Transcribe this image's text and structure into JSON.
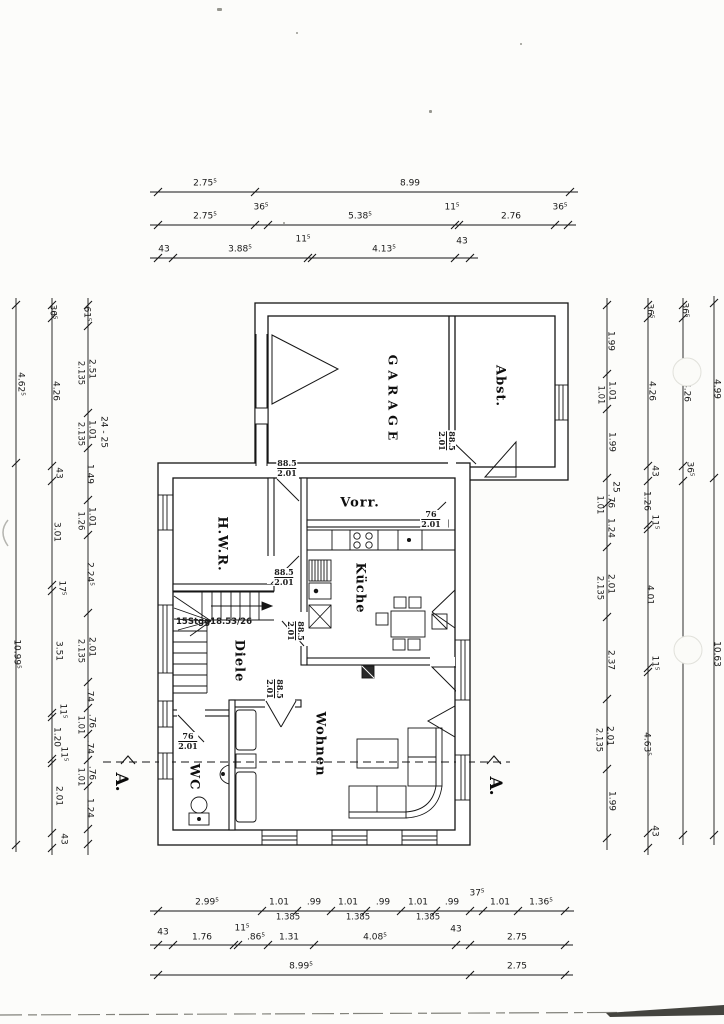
{
  "drawing_title": "Erdgeschoss Grundriss (scanned floor plan)",
  "rooms": [
    {
      "label": "GARAGE",
      "x": 393,
      "y": 400,
      "r": 90,
      "spaced": true
    },
    {
      "label": "Abst.",
      "x": 500,
      "y": 386,
      "r": 90,
      "spaced": false
    },
    {
      "label": "Vorr.",
      "x": 360,
      "y": 503,
      "r": 0,
      "spaced": false
    },
    {
      "label": "H.W.R.",
      "x": 222,
      "y": 544,
      "r": 90,
      "spaced": false
    },
    {
      "label": "Küche",
      "x": 360,
      "y": 588,
      "r": 90,
      "spaced": false
    },
    {
      "label": "Diele",
      "x": 239,
      "y": 661,
      "r": 90,
      "spaced": false
    },
    {
      "label": "WC",
      "x": 194,
      "y": 777,
      "r": 90,
      "spaced": false
    },
    {
      "label": "Wohnen",
      "x": 320,
      "y": 744,
      "r": 90,
      "spaced": false
    }
  ],
  "section_markers": [
    {
      "label": "A.",
      "x": 121,
      "y": 782
    },
    {
      "label": "A.",
      "x": 495,
      "y": 786
    }
  ],
  "stair_note": {
    "text": "15Stgg18.53/26",
    "x": 214,
    "y": 622
  },
  "door_labels": [
    {
      "w": "88.5",
      "h": "2.01",
      "x": 287,
      "y": 468,
      "r": 0
    },
    {
      "w": "88.5",
      "h": "2.01",
      "x": 447,
      "y": 441,
      "r": 90
    },
    {
      "w": "76",
      "h": "2.01",
      "x": 431,
      "y": 519,
      "r": 0
    },
    {
      "w": "88.5",
      "h": "2.01",
      "x": 284,
      "y": 577,
      "r": 0
    },
    {
      "w": "88.5",
      "h": "2.01",
      "x": 296,
      "y": 631,
      "r": 90
    },
    {
      "w": "88.5",
      "h": "2.01",
      "x": 275,
      "y": 689,
      "r": 90
    },
    {
      "w": "76",
      "h": "2.01",
      "x": 188,
      "y": 741,
      "r": 0
    }
  ],
  "dim_labels": [
    {
      "t": "2.75⁵",
      "x": 205,
      "y": 184,
      "r": 0
    },
    {
      "t": "8.99",
      "x": 410,
      "y": 184,
      "r": 0
    },
    {
      "t": "2.75⁵",
      "x": 205,
      "y": 217,
      "r": 0
    },
    {
      "t": "36⁵",
      "x": 261,
      "y": 208,
      "r": 0
    },
    {
      "t": "5.38⁵",
      "x": 360,
      "y": 217,
      "r": 0
    },
    {
      "t": "11⁵",
      "x": 452,
      "y": 208,
      "r": 0
    },
    {
      "t": "2.76",
      "x": 511,
      "y": 217,
      "r": 0
    },
    {
      "t": "36⁵",
      "x": 560,
      "y": 208,
      "r": 0
    },
    {
      "t": "43",
      "x": 164,
      "y": 250,
      "r": 0
    },
    {
      "t": "3.88⁵",
      "x": 240,
      "y": 250,
      "r": 0
    },
    {
      "t": "11⁵",
      "x": 303,
      "y": 240,
      "r": 0
    },
    {
      "t": "4.13⁵",
      "x": 384,
      "y": 250,
      "r": 0
    },
    {
      "t": "43",
      "x": 462,
      "y": 242,
      "r": 0
    },
    {
      "t": "2.99⁵",
      "x": 207,
      "y": 903,
      "r": 0
    },
    {
      "t": "1.01",
      "x": 279,
      "y": 903,
      "r": 0
    },
    {
      "t": ".99",
      "x": 314,
      "y": 903,
      "r": 0
    },
    {
      "t": "1.01",
      "x": 348,
      "y": 903,
      "r": 0
    },
    {
      "t": ".99",
      "x": 383,
      "y": 903,
      "r": 0
    },
    {
      "t": "1.01",
      "x": 418,
      "y": 903,
      "r": 0
    },
    {
      "t": ".99",
      "x": 452,
      "y": 903,
      "r": 0
    },
    {
      "t": "37⁵",
      "x": 477,
      "y": 894,
      "r": 0
    },
    {
      "t": "1.01",
      "x": 500,
      "y": 903,
      "r": 0
    },
    {
      "t": "1.36⁵",
      "x": 541,
      "y": 903,
      "r": 0
    },
    {
      "t": "1.385",
      "x": 288,
      "y": 918,
      "r": 0,
      "sub": true
    },
    {
      "t": "1.385",
      "x": 358,
      "y": 918,
      "r": 0,
      "sub": true
    },
    {
      "t": "1.385",
      "x": 428,
      "y": 918,
      "r": 0,
      "sub": true
    },
    {
      "t": "43",
      "x": 163,
      "y": 933,
      "r": 0
    },
    {
      "t": "1.76",
      "x": 202,
      "y": 938,
      "r": 0
    },
    {
      "t": "11⁵",
      "x": 242,
      "y": 929,
      "r": 0
    },
    {
      "t": ".86⁵",
      "x": 256,
      "y": 938,
      "r": 0
    },
    {
      "t": "1.31",
      "x": 289,
      "y": 938,
      "r": 0
    },
    {
      "t": "4.08⁵",
      "x": 375,
      "y": 938,
      "r": 0
    },
    {
      "t": "43",
      "x": 456,
      "y": 930,
      "r": 0
    },
    {
      "t": "2.75",
      "x": 517,
      "y": 938,
      "r": 0
    },
    {
      "t": "8.99⁵",
      "x": 301,
      "y": 967,
      "r": 0
    },
    {
      "t": "2.75",
      "x": 517,
      "y": 967,
      "r": 0
    },
    {
      "t": "4.62⁵",
      "x": 20,
      "y": 384,
      "r": 90
    },
    {
      "t": "10.99⁵",
      "x": 16,
      "y": 654,
      "r": 90
    },
    {
      "t": "36⁵",
      "x": 52,
      "y": 312,
      "r": 90
    },
    {
      "t": "4.26",
      "x": 55,
      "y": 391,
      "r": 90
    },
    {
      "t": "43",
      "x": 58,
      "y": 473,
      "r": 90
    },
    {
      "t": "3.01",
      "x": 56,
      "y": 532,
      "r": 90
    },
    {
      "t": "17⁵",
      "x": 61,
      "y": 588,
      "r": 90
    },
    {
      "t": "3.51",
      "x": 58,
      "y": 651,
      "r": 90
    },
    {
      "t": "11⁵",
      "x": 62,
      "y": 711,
      "r": 90
    },
    {
      "t": "1.20",
      "x": 56,
      "y": 737,
      "r": 90
    },
    {
      "t": "11⁵",
      "x": 63,
      "y": 754,
      "r": 90
    },
    {
      "t": "2.01",
      "x": 58,
      "y": 796,
      "r": 90
    },
    {
      "t": "43",
      "x": 63,
      "y": 839,
      "r": 90
    },
    {
      "t": "61⁵",
      "x": 86,
      "y": 314,
      "r": 90
    },
    {
      "t": "2.51",
      "x": 91,
      "y": 369,
      "r": 90
    },
    {
      "t": "2.135",
      "x": 80,
      "y": 373,
      "r": 90,
      "sub": true
    },
    {
      "t": "1.01",
      "x": 91,
      "y": 430,
      "r": 90
    },
    {
      "t": "2.135",
      "x": 80,
      "y": 434,
      "r": 90,
      "sub": true
    },
    {
      "t": "24 - 25",
      "x": 103,
      "y": 432,
      "r": 90
    },
    {
      "t": "1.49",
      "x": 89,
      "y": 474,
      "r": 90
    },
    {
      "t": "1.01",
      "x": 91,
      "y": 517,
      "r": 90
    },
    {
      "t": "1.26",
      "x": 80,
      "y": 521,
      "r": 90,
      "sub": true
    },
    {
      "t": "2.24⁵",
      "x": 89,
      "y": 574,
      "r": 90
    },
    {
      "t": "2.01",
      "x": 91,
      "y": 647,
      "r": 90
    },
    {
      "t": "2.135",
      "x": 80,
      "y": 651,
      "r": 90,
      "sub": true
    },
    {
      "t": ".74",
      "x": 89,
      "y": 695,
      "r": 90
    },
    {
      "t": ".76",
      "x": 91,
      "y": 721,
      "r": 90
    },
    {
      "t": "1.01",
      "x": 80,
      "y": 725,
      "r": 90,
      "sub": true
    },
    {
      "t": ".74",
      "x": 89,
      "y": 747,
      "r": 90
    },
    {
      "t": ".76",
      "x": 91,
      "y": 773,
      "r": 90
    },
    {
      "t": "1.01",
      "x": 80,
      "y": 777,
      "r": 90,
      "sub": true
    },
    {
      "t": "1.24",
      "x": 89,
      "y": 808,
      "r": 90
    },
    {
      "t": "1.99",
      "x": 610,
      "y": 341,
      "r": 90
    },
    {
      "t": "1.01",
      "x": 611,
      "y": 391,
      "r": 90
    },
    {
      "t": "1.01",
      "x": 600,
      "y": 395,
      "r": 90,
      "sub": true
    },
    {
      "t": "1.99",
      "x": 611,
      "y": 442,
      "r": 90
    },
    {
      "t": "25",
      "x": 615,
      "y": 487,
      "r": 90
    },
    {
      "t": ".76",
      "x": 610,
      "y": 501,
      "r": 90
    },
    {
      "t": "1.01",
      "x": 599,
      "y": 505,
      "r": 90,
      "sub": true
    },
    {
      "t": "1.24",
      "x": 610,
      "y": 528,
      "r": 90
    },
    {
      "t": "2.01",
      "x": 610,
      "y": 584,
      "r": 90
    },
    {
      "t": "2.135",
      "x": 599,
      "y": 588,
      "r": 90,
      "sub": true
    },
    {
      "t": "2.37",
      "x": 610,
      "y": 660,
      "r": 90
    },
    {
      "t": "2.01",
      "x": 609,
      "y": 736,
      "r": 90
    },
    {
      "t": "2.135",
      "x": 598,
      "y": 740,
      "r": 90,
      "sub": true
    },
    {
      "t": "1.99",
      "x": 611,
      "y": 801,
      "r": 90
    },
    {
      "t": "36⁵",
      "x": 649,
      "y": 311,
      "r": 90
    },
    {
      "t": "4.26",
      "x": 651,
      "y": 391,
      "r": 90
    },
    {
      "t": "43",
      "x": 654,
      "y": 471,
      "r": 90
    },
    {
      "t": "1.26",
      "x": 646,
      "y": 501,
      "r": 90
    },
    {
      "t": "11⁵",
      "x": 654,
      "y": 522,
      "r": 90
    },
    {
      "t": "4.01",
      "x": 649,
      "y": 595,
      "r": 90
    },
    {
      "t": "11⁵",
      "x": 654,
      "y": 663,
      "r": 90
    },
    {
      "t": "4.63⁵",
      "x": 646,
      "y": 744,
      "r": 90
    },
    {
      "t": "43",
      "x": 654,
      "y": 831,
      "r": 90
    },
    {
      "t": "36⁵",
      "x": 684,
      "y": 310,
      "r": 90
    },
    {
      "t": "4.26",
      "x": 686,
      "y": 392,
      "r": 90
    },
    {
      "t": "36⁵",
      "x": 689,
      "y": 469,
      "r": 90
    },
    {
      "t": "4.99",
      "x": 716,
      "y": 389,
      "r": 90
    },
    {
      "t": "10.63",
      "x": 716,
      "y": 654,
      "r": 90
    }
  ],
  "artifacts": {
    "hole_punches": [
      {
        "x": 687,
        "y": 372
      },
      {
        "x": 688,
        "y": 650
      }
    ],
    "specks": [
      {
        "x": 217,
        "y": 8,
        "w": 5,
        "h": 3
      },
      {
        "x": 296,
        "y": 32,
        "w": 2,
        "h": 2
      },
      {
        "x": 283,
        "y": 222,
        "w": 2,
        "h": 2
      },
      {
        "x": 429,
        "y": 110,
        "w": 3,
        "h": 3
      },
      {
        "x": 520,
        "y": 43,
        "w": 2,
        "h": 2
      }
    ]
  }
}
